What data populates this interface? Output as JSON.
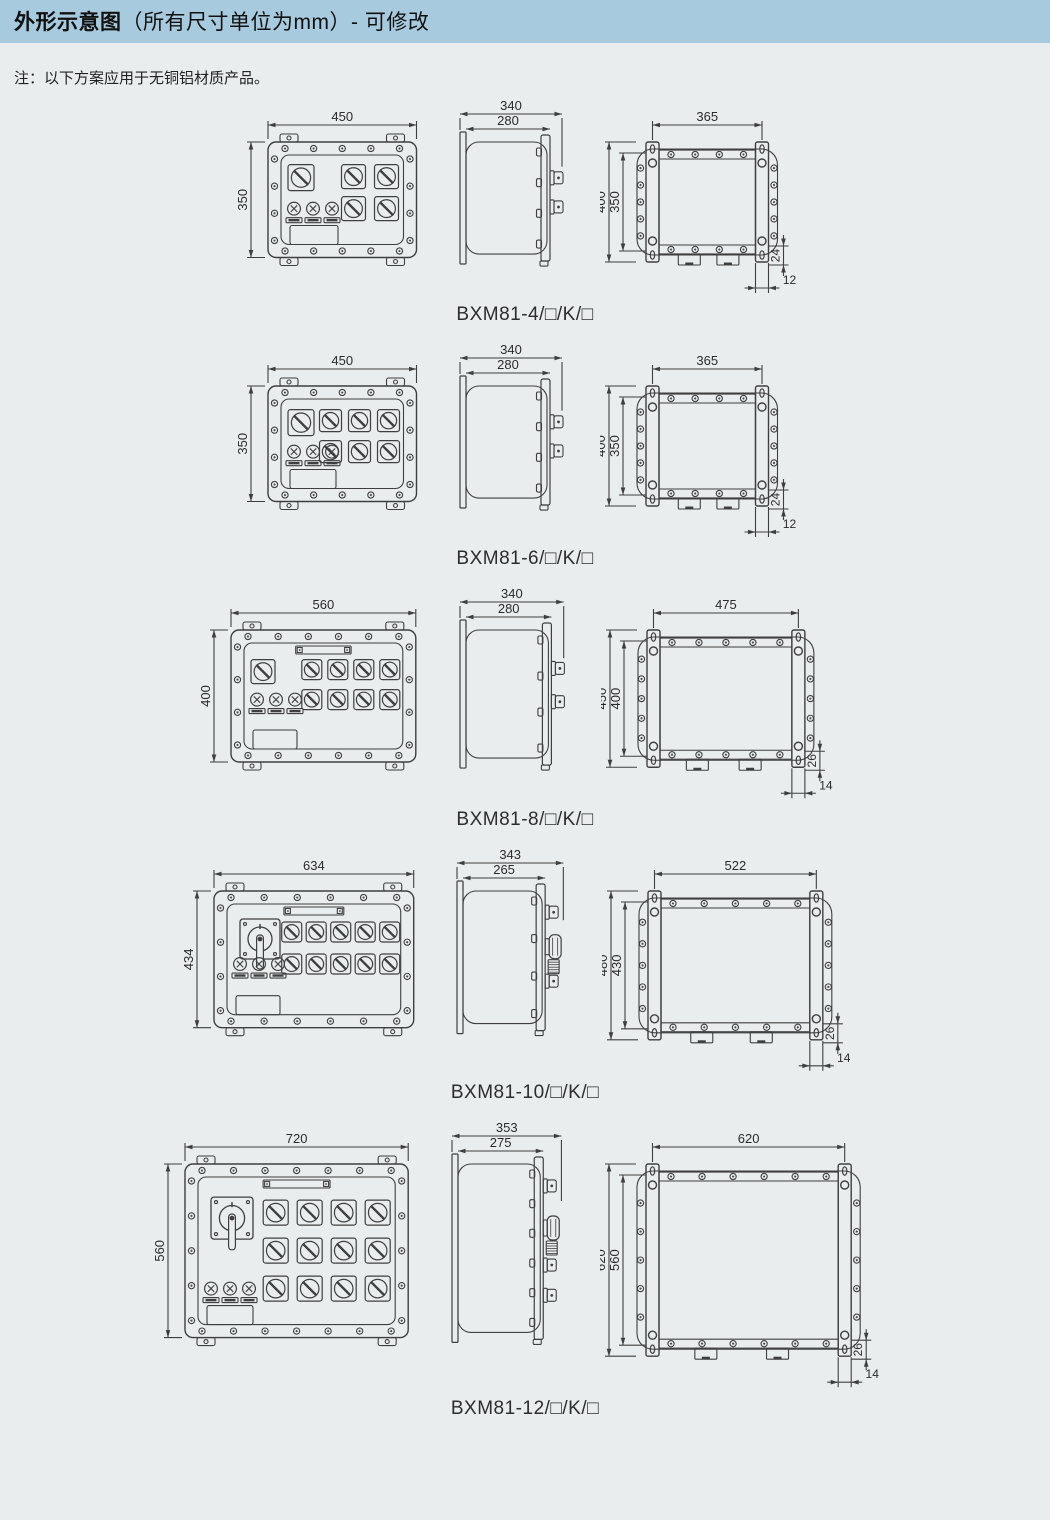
{
  "page": {
    "title_bold": "外形示意图",
    "title_rest": "（所有尺寸单位为mm）- 可修改",
    "note": "注：以下方案应用于无铜铝材质产品。"
  },
  "units": "mm",
  "models": [
    {
      "model": "BXM81-4/□/K/□",
      "front": {
        "width": "450",
        "height": "350"
      },
      "side": {
        "overall_depth": "340",
        "body_depth": "280"
      },
      "back": {
        "mount_width": "365",
        "overall_height": "400",
        "mount_height": "350",
        "foot_height": "24",
        "foot_offset": "12"
      },
      "layout": {
        "main_switch": "compact",
        "grid_cols": 2,
        "grid_rows": 2,
        "indicators": 3,
        "top_strip": false,
        "side_operators": [
          "stub",
          "stub"
        ]
      }
    },
    {
      "model": "BXM81-6/□/K/□",
      "front": {
        "width": "450",
        "height": "350"
      },
      "side": {
        "overall_depth": "340",
        "body_depth": "280"
      },
      "back": {
        "mount_width": "365",
        "overall_height": "400",
        "mount_height": "350",
        "foot_height": "24",
        "foot_offset": "12"
      },
      "layout": {
        "main_switch": "compact",
        "grid_cols": 3,
        "grid_rows": 2,
        "indicators": 3,
        "top_strip": false,
        "side_operators": [
          "stub",
          "stub"
        ]
      }
    },
    {
      "model": "BXM81-8/□/K/□",
      "front": {
        "width": "560",
        "height": "400"
      },
      "side": {
        "overall_depth": "340",
        "body_depth": "280"
      },
      "back": {
        "mount_width": "475",
        "overall_height": "450",
        "mount_height": "400",
        "foot_height": "26",
        "foot_offset": "14"
      },
      "layout": {
        "main_switch": "compact",
        "grid_cols": 4,
        "grid_rows": 2,
        "indicators": 3,
        "top_strip": true,
        "side_operators": [
          "stub",
          "stub"
        ]
      }
    },
    {
      "model": "BXM81-10/□/K/□",
      "front": {
        "width": "634",
        "height": "434"
      },
      "side": {
        "overall_depth": "343",
        "body_depth": "265"
      },
      "back": {
        "mount_width": "522",
        "overall_height": "480",
        "mount_height": "430",
        "foot_height": "26",
        "foot_offset": "14"
      },
      "layout": {
        "main_switch": "lever",
        "grid_cols": 5,
        "grid_rows": 2,
        "indicators": 3,
        "top_strip": true,
        "side_operators": [
          "stub",
          "knob",
          "stub"
        ]
      }
    },
    {
      "model": "BXM81-12/□/K/□",
      "front": {
        "width": "720",
        "height": "560"
      },
      "side": {
        "overall_depth": "353",
        "body_depth": "275"
      },
      "back": {
        "mount_width": "620",
        "overall_height": "620",
        "mount_height": "560",
        "foot_height": "26",
        "foot_offset": "14"
      },
      "layout": {
        "main_switch": "lever",
        "grid_cols": 4,
        "grid_rows": 3,
        "indicators": 3,
        "top_strip": true,
        "side_operators": [
          "stub",
          "knob",
          "stub",
          "stub"
        ]
      }
    }
  ]
}
